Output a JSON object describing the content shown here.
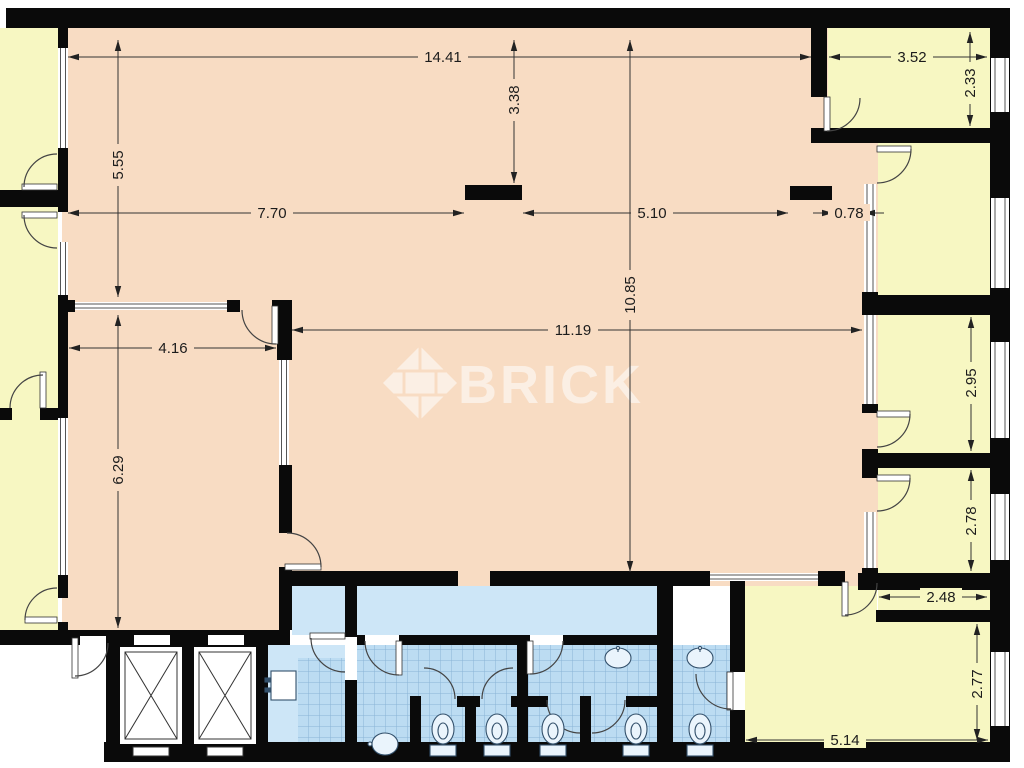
{
  "page": {
    "type": "architectural-floor-plan"
  },
  "watermark": {
    "brand": "BRICK",
    "logo": "brick-diamond-logo"
  },
  "colors": {
    "room_main": "#f8dcc3",
    "room_side": "#f7f7c2",
    "wall": "#0a0a0a",
    "bath_tile": "#bcdcf2",
    "bath_corridor": "#cde6f7",
    "tile_line": "#8ab4d6",
    "dimension_text": "#1c1c1c",
    "watermark_color": "#ffffff"
  },
  "fixtures": {
    "elevator_count": 2,
    "toilet_count": 5,
    "sink_count": 3
  },
  "dimensions": [
    {
      "value": "14.41",
      "axis": "h",
      "x1": 68,
      "x2": 811,
      "y": 57,
      "lx": 443,
      "bg": "#f8dcc3"
    },
    {
      "value": "3.52",
      "axis": "h",
      "x1": 829,
      "x2": 987,
      "y": 57,
      "lx": 912,
      "bg": "#f7f7c2"
    },
    {
      "value": "2.33",
      "axis": "v",
      "x": 970,
      "y1": 32,
      "y2": 126,
      "ly": 83,
      "bg": "#f7f7c2"
    },
    {
      "value": "5.55",
      "axis": "v",
      "x": 118,
      "y1": 40,
      "y2": 297,
      "ly": 165,
      "bg": "#f8dcc3"
    },
    {
      "value": "3.38",
      "axis": "v",
      "x": 514,
      "y1": 40,
      "y2": 183,
      "ly": 100,
      "bg": "#f8dcc3"
    },
    {
      "value": "7.70",
      "axis": "h",
      "x1": 68,
      "x2": 464,
      "y": 213,
      "lx": 272,
      "bg": "#f8dcc3"
    },
    {
      "value": "5.10",
      "axis": "h",
      "x1": 523,
      "x2": 788,
      "y": 213,
      "lx": 652,
      "bg": "#f8dcc3"
    },
    {
      "value": "0.78",
      "axis": "h",
      "x1": 833,
      "x2": 864,
      "y": 213,
      "lx": 849,
      "bg": "#f8dcc3",
      "outside": true
    },
    {
      "value": "10.85",
      "axis": "v",
      "x": 630,
      "y1": 40,
      "y2": 572,
      "ly": 295,
      "bg": "#f8dcc3"
    },
    {
      "value": "11.19",
      "axis": "h",
      "x1": 292,
      "x2": 862,
      "y": 330,
      "lx": 573,
      "bg": "#f8dcc3"
    },
    {
      "value": "4.16",
      "axis": "h",
      "x1": 69,
      "x2": 276,
      "y": 348,
      "lx": 173,
      "bg": "#f8dcc3"
    },
    {
      "value": "6.29",
      "axis": "v",
      "x": 118,
      "y1": 315,
      "y2": 628,
      "ly": 470,
      "bg": "#f8dcc3"
    },
    {
      "value": "2.95",
      "axis": "v",
      "x": 971,
      "y1": 317,
      "y2": 451,
      "ly": 383,
      "bg": "#f7f7c2"
    },
    {
      "value": "2.78",
      "axis": "v",
      "x": 971,
      "y1": 470,
      "y2": 571,
      "ly": 521,
      "bg": "#f7f7c2"
    },
    {
      "value": "2.48",
      "axis": "h",
      "x1": 879,
      "x2": 987,
      "y": 597,
      "lx": 941,
      "bg": "#f7f7c2"
    },
    {
      "value": "2.77",
      "axis": "v",
      "x": 977,
      "y1": 624,
      "y2": 740,
      "ly": 684,
      "bg": "#f7f7c2"
    },
    {
      "value": "5.14",
      "axis": "h",
      "x1": 746,
      "x2": 988,
      "y": 740,
      "lx": 845,
      "bg": "#f7f7c2"
    }
  ]
}
